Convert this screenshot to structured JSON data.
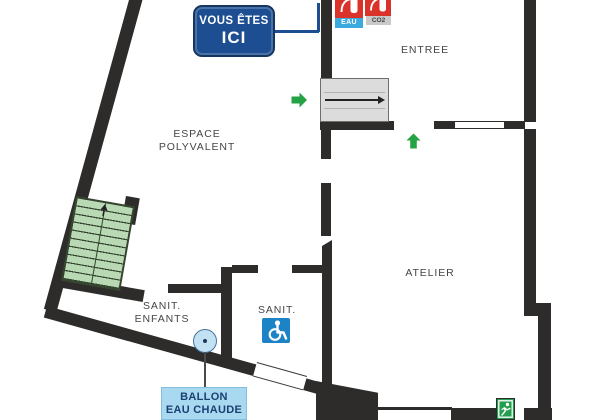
{
  "sign": {
    "line1": "VOUS ÊTES",
    "line2": "ICI"
  },
  "rooms": {
    "entree": {
      "label": "ENTREE"
    },
    "espace_polyvalent": {
      "line1": "ESPACE",
      "line2": "POLYVALENT"
    },
    "atelier": {
      "label": "ATELIER"
    },
    "sanit_enfants": {
      "line1": "SANIT.",
      "line2": "ENFANTS"
    },
    "sanit": {
      "label": "SANIT."
    }
  },
  "equipment": {
    "extinguishers": [
      {
        "type": "EAU"
      },
      {
        "type": "CO2"
      }
    ],
    "hot_water_tank": {
      "line1": "BALLON",
      "line2": "EAU CHAUDE"
    }
  },
  "icons": {
    "fire_extinguisher": "red square with white extinguisher pictogram",
    "accessible_wc": "white wheelchair on blue square",
    "emergency_exit": "white running man on green square",
    "evacuation_arrow": "solid green arrow",
    "hot_water_tank_marker": "light blue circle with center dot",
    "stairs": "green staircase with up arrow",
    "entrance_steps": "grey steps with direction arrow"
  },
  "colors": {
    "wall": "#2d2c2a",
    "sign_blue": "#1d4e91",
    "callout_blue_bg": "#a9d9f0",
    "callout_text": "#1b3f71",
    "extinguisher_red": "#d9332a",
    "eau_badge_blue": "#3aa9de",
    "co2_badge_grey": "#c9c9c9",
    "accessible_blue": "#1c84c6",
    "exit_green": "#259d4f",
    "arrow_green": "#25a244",
    "stairs_green": "#b9d9b4",
    "entrance_steps_grey": "#dcdcdc"
  }
}
